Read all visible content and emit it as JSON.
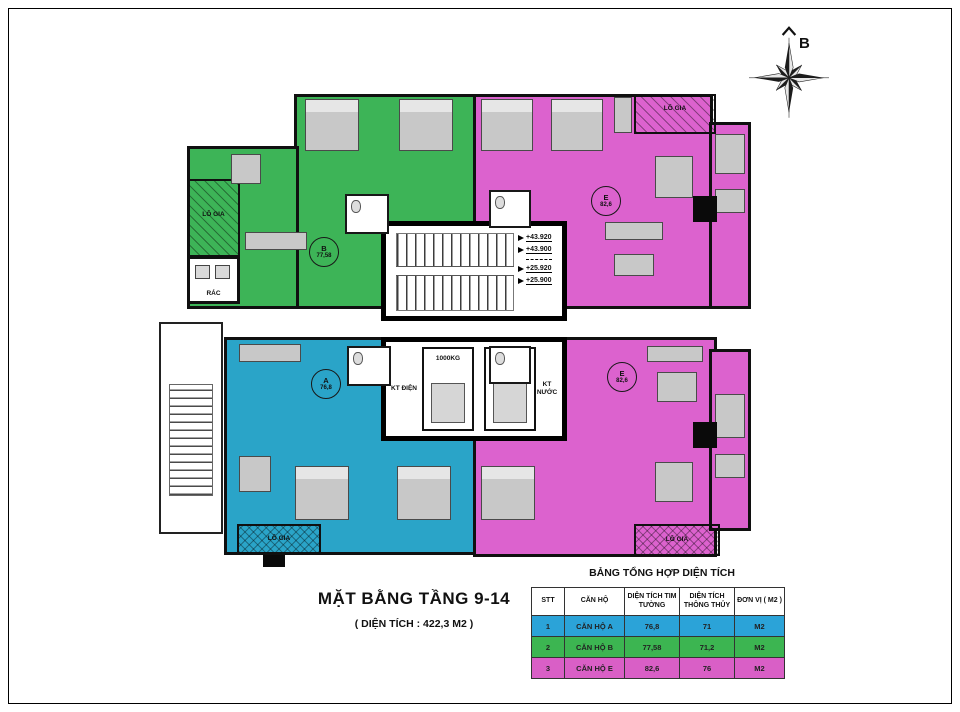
{
  "page": {
    "title": "MẶT BẰNG TẦNG 9-14",
    "subtitle": "( DIỆN TÍCH : 422,3 M2 )"
  },
  "compass": {
    "label": "B"
  },
  "plan": {
    "apartments": {
      "a": {
        "letter": "A",
        "area": "76,8",
        "color": "#2aa4c8"
      },
      "b": {
        "letter": "B",
        "area": "77,58",
        "color": "#3db457"
      },
      "e_top": {
        "letter": "E",
        "area": "82,6",
        "color": "#dc62ce"
      },
      "e_bottom": {
        "letter": "E",
        "area": "82,6",
        "color": "#dc62ce"
      }
    },
    "labels": {
      "balcony_top_right": "LÔ GIA",
      "balcony_left": "LÔ GIA",
      "balcony_bottom_left": "LÔ GIA",
      "balcony_bottom_right": "LÔ GIA",
      "trash": "RÁC",
      "kt_dien": "KT ĐIỆN",
      "kt_nuoc": "KT NƯỚC",
      "elevator_1": "1000KG",
      "elevator_2": "1000KG"
    },
    "elevations": [
      "+43.920",
      "+43.900",
      "+25.920",
      "+25.900"
    ]
  },
  "summary": {
    "title": "BẢNG TỔNG HỢP DIỆN TÍCH",
    "columns": [
      "STT",
      "CĂN HỘ",
      "DIỆN TÍCH TIM TƯỜNG",
      "DIỆN TÍCH THÔNG THỦY",
      "ĐƠN VỊ ( M2 )"
    ],
    "rows": [
      {
        "stt": "1",
        "name": "CĂN HỘ A",
        "tim_tuong": "76,8",
        "thong_thuy": "71",
        "don_vi": "M2",
        "color": "#2ba3d8"
      },
      {
        "stt": "2",
        "name": "CĂN HỘ B",
        "tim_tuong": "77,58",
        "thong_thuy": "71,2",
        "don_vi": "M2",
        "color": "#3cb551"
      },
      {
        "stt": "3",
        "name": "CĂN HỘ E",
        "tim_tuong": "82,6",
        "thong_thuy": "76",
        "don_vi": "M2",
        "color": "#d95fc6"
      }
    ]
  }
}
